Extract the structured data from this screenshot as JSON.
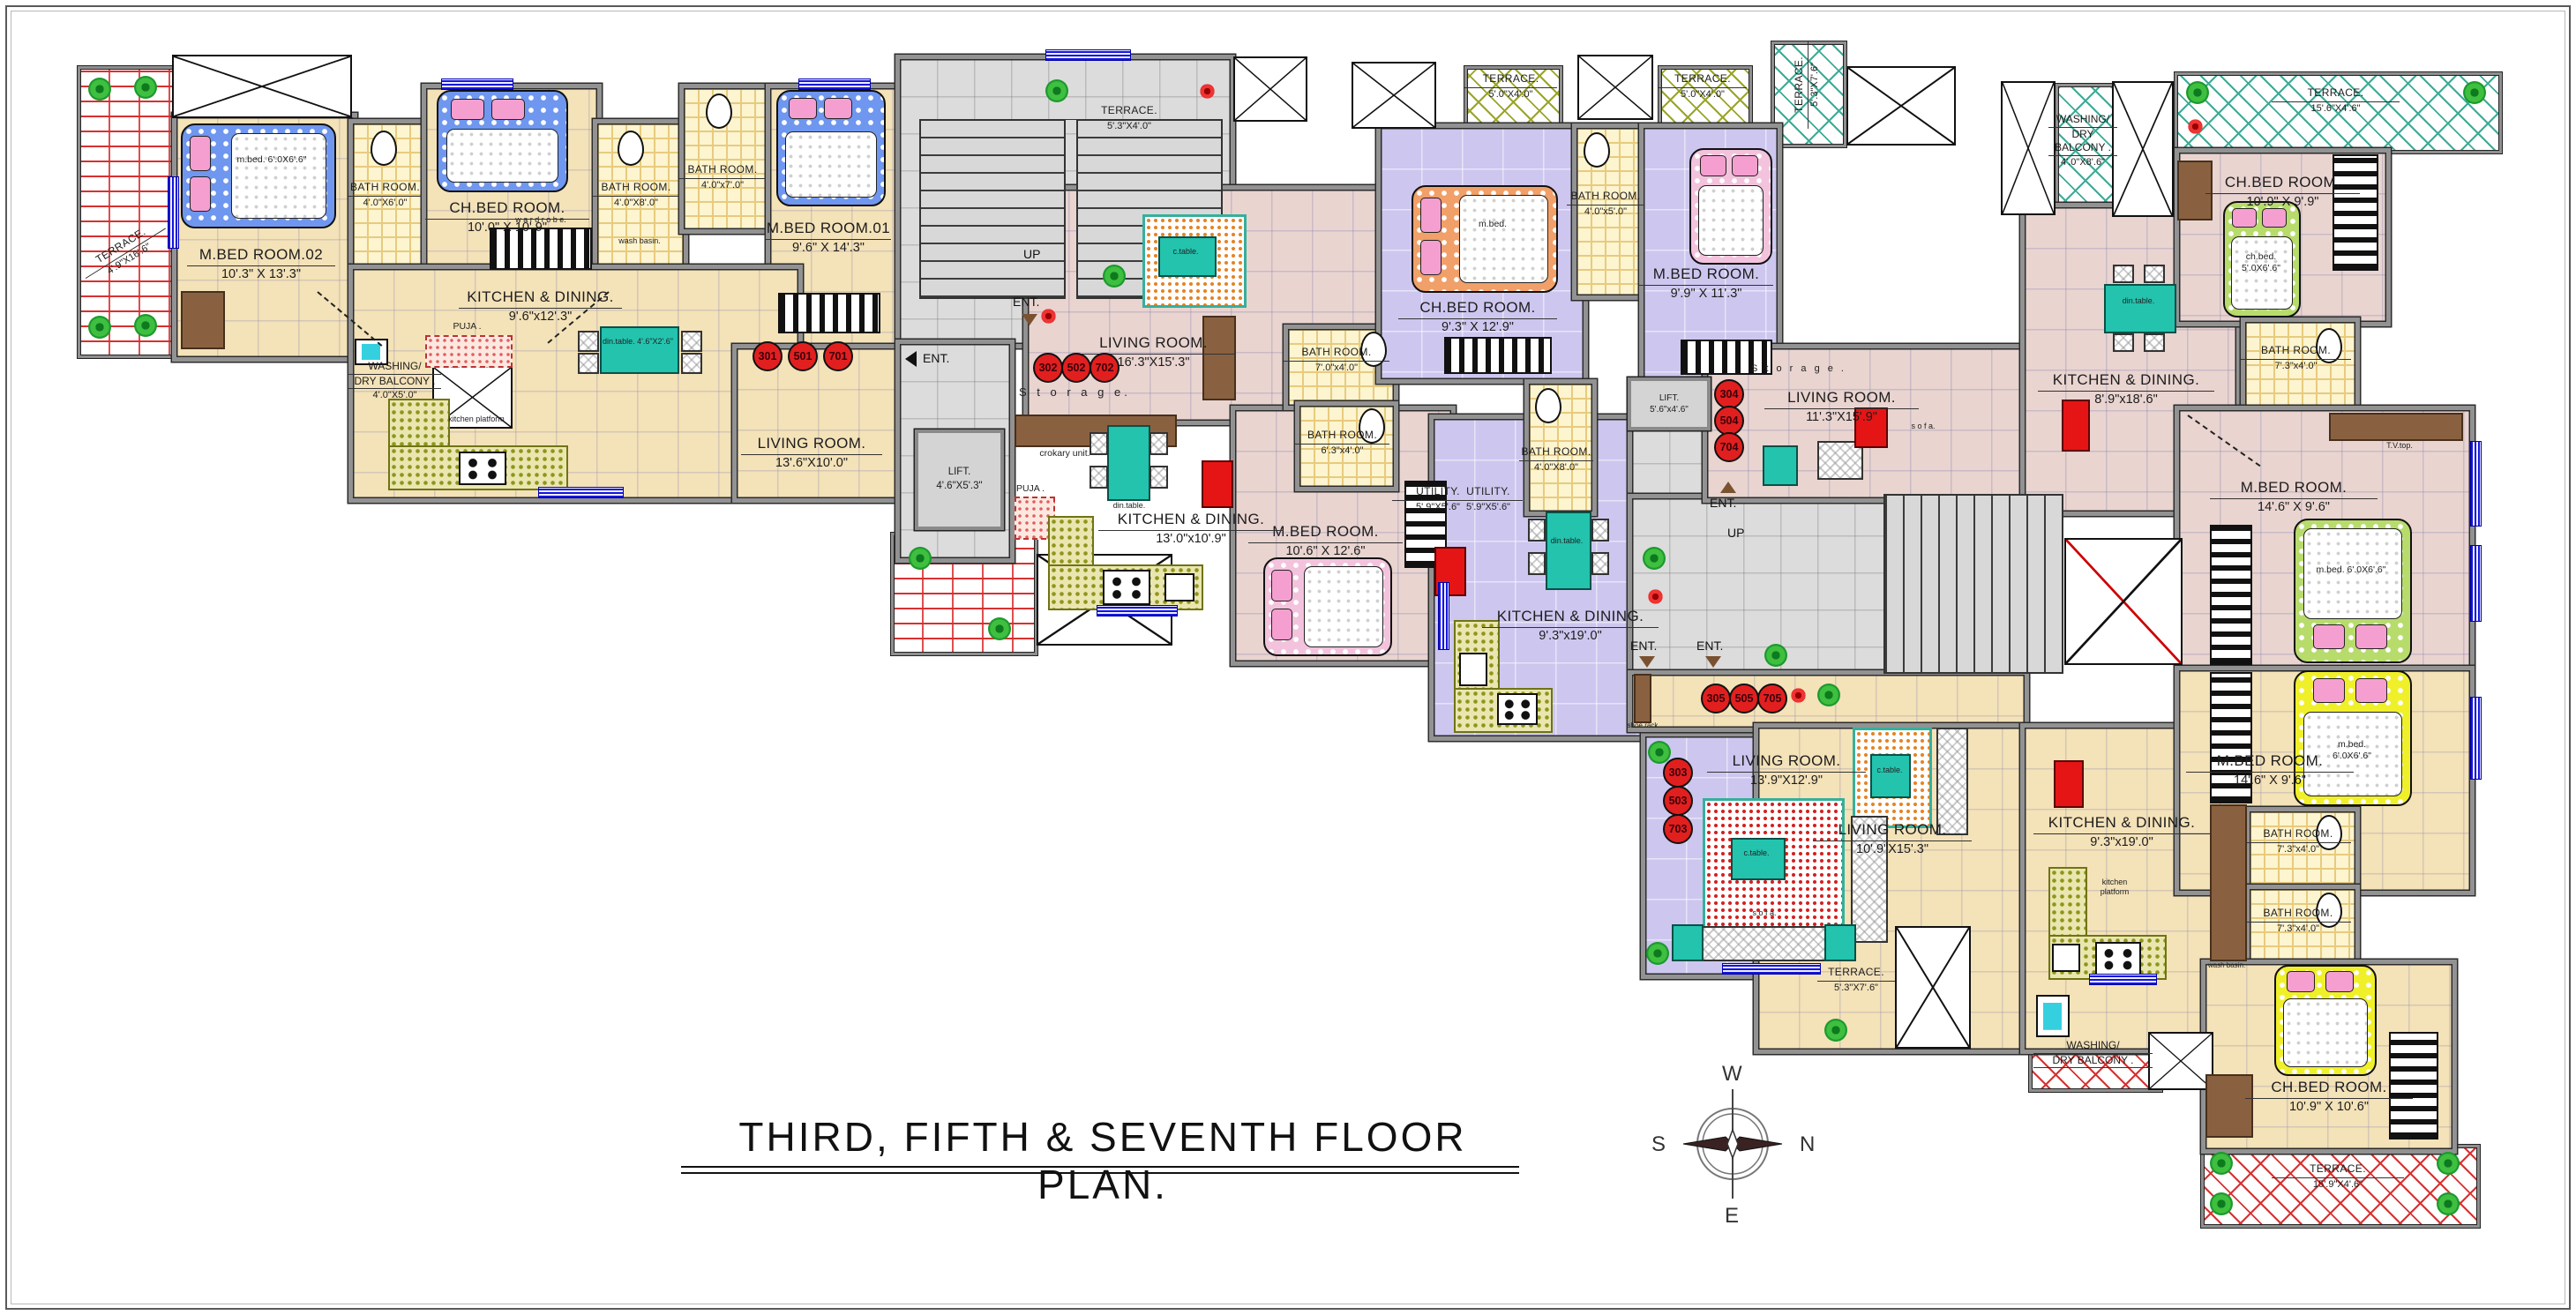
{
  "title": {
    "text": "THIRD, FIFTH & SEVENTH FLOOR PLAN."
  },
  "compass": {
    "west": "W",
    "south": "S",
    "north": "N",
    "east": "E"
  },
  "colors": {
    "wall": "#929292",
    "window_blue": "#1515dd",
    "unit_number_red": "#e21f1f",
    "furniture_teal": "#23c3ae",
    "terrace_red": "#d83030",
    "terrace_teal": "#3cab96",
    "floor_tan": "#f4e2b8",
    "floor_pink": "#e9d4d0",
    "floor_lavender": "#cdc7ef"
  },
  "cores": {
    "left": {
      "ent": "ENT.",
      "up": "UP",
      "lift_name": "LIFT.",
      "lift_dims": "4'.6\"X5'.3\""
    },
    "right": {
      "ent": "ENT.",
      "up": "UP",
      "lift_name": "LIFT.",
      "lift_dims": "5'.6\"x4'.6\"",
      "storage": "S t o r a g e ."
    }
  },
  "units": {
    "u301": {
      "numbers": [
        "301",
        "501",
        "701"
      ],
      "terrace": {
        "name": "TERRACE.",
        "dims": "4'.9\"X16'.6\""
      },
      "m_bed_02": {
        "name": "M.BED ROOM.02",
        "dims": "10'.3\" X 13'.3\""
      },
      "bath_1": {
        "name": "BATH ROOM.",
        "dims": "4'.0\"X6'.0\""
      },
      "ch_bed": {
        "name": "CH.BED ROOM.",
        "dims": "10'.0\" X 10'.9\""
      },
      "bath_2": {
        "name": "BATH ROOM.",
        "dims": "4'.0\"X8'.0\""
      },
      "bath_3": {
        "name": "BATH ROOM.",
        "dims": "4'.0\"x7'.0\""
      },
      "m_bed_01": {
        "name": "M.BED ROOM.01",
        "dims": "9'.6\" X 14'.3\""
      },
      "kitchen": {
        "name": "KITCHEN & DINING.",
        "dims": "9'.6\"x12'.3\""
      },
      "living": {
        "name": "LIVING ROOM.",
        "dims": "13'.6\"X10'.0\""
      },
      "puja": "PUJA .",
      "wash_balcony": {
        "line1": "WASHING/",
        "line2": "DRY BALCONY .",
        "dims": "4'.0\"X5'.0\""
      }
    },
    "u302": {
      "numbers": [
        "302",
        "502",
        "702"
      ],
      "terrace": {
        "name": "TERRACE.",
        "dims": "5'.3\"X4'.0\""
      },
      "living": {
        "name": "LIVING ROOM.",
        "dims": "16'.3\"X15'.3\""
      },
      "kitchen": {
        "name": "KITCHEN & DINING.",
        "dims": "13'.0\"x10'.9\""
      },
      "m_bed": {
        "name": "M.BED ROOM.",
        "dims": "10'.6\" X 12'.6\""
      },
      "bath_1": {
        "name": "BATH ROOM.",
        "dims": "7'.0\"x4'.0\""
      },
      "bath_2": {
        "name": "BATH ROOM.",
        "dims": "6'.3\"x4'.0\""
      },
      "utility": {
        "name": "UTILITY.",
        "dims": "5'.9\"X5'.6\""
      },
      "puja": "PUJA .",
      "storage": "S t o r a g e.",
      "crokary": "crokary unit."
    },
    "u303": {
      "numbers": [
        "303",
        "503",
        "703"
      ],
      "terrace_1": {
        "name": "TERRACE.",
        "dims": "5'.0\"X4'.0\""
      },
      "terrace_2": {
        "name": "TERRACE.",
        "dims": "5'.0\"X4'.0\""
      },
      "ch_bed": {
        "name": "CH.BED ROOM.",
        "dims": "9'.3\" X 12'.9\""
      },
      "m_bed": {
        "name": "M.BED ROOM.",
        "dims": "9'.9\" X 11'.3\""
      },
      "bath_1": {
        "name": "BATH ROOM.",
        "dims": "4'.0\"x5'.0\""
      },
      "bath_2": {
        "name": "BATH ROOM.",
        "dims": "4'.0\"X8'.0\""
      },
      "utility": {
        "name": "UTILITY.",
        "dims": "5'.9\"X5'.6\""
      },
      "kitchen": {
        "name": "KITCHEN & DINING.",
        "dims": "9'.3\"x19'.0\""
      },
      "living": {
        "name": "LIVING ROOM.",
        "dims": "13'.9\"X12'.9\""
      }
    },
    "u304": {
      "numbers": [
        "304",
        "504",
        "704"
      ],
      "living": {
        "name": "LIVING ROOM.",
        "dims": "11'.3\"X15'.9\""
      },
      "kitchen": {
        "name": "KITCHEN & DINING.",
        "dims": "8'.9\"x18'.6\""
      },
      "wash_balcony": {
        "line1": "WASHING/",
        "line2": "DRY BALCONY .",
        "dims": "4'.0\"X8'.6\""
      },
      "terrace_top": {
        "name": "TERRACE.",
        "dims": "15'.6\"X4'.6\""
      },
      "terrace_side": {
        "name": "TERRACE.",
        "dims": "5'.3\"X7'.6\""
      },
      "ch_bed": {
        "name": "CH.BED ROOM.",
        "dims": "10'.9\" X 9'.9\""
      },
      "bath": {
        "name": "BATH ROOM.",
        "dims": "7'.3\"x4'.0\""
      },
      "m_bed": {
        "name": "M.BED ROOM.",
        "dims": "14'.6\" X 9'.6\""
      }
    },
    "u305": {
      "numbers": [
        "305",
        "505",
        "705"
      ],
      "living": {
        "name": "LIVING ROOM.",
        "dims": "10'.9\"X15'.3\""
      },
      "kitchen": {
        "name": "KITCHEN & DINING.",
        "dims": "9'.3\"x19'.0\""
      },
      "m_bed": {
        "name": "M.BED ROOM.",
        "dims": "14'.6\" X 9'.6\""
      },
      "bath_1": {
        "name": "BATH ROOM.",
        "dims": "7'.3\"x4'.0\""
      },
      "bath_2": {
        "name": "BATH ROOM.",
        "dims": "7'.3\"x4'.0\""
      },
      "ch_bed": {
        "name": "CH.BED ROOM.",
        "dims": "10'.9\" X 10'.6\""
      },
      "terrace_side": {
        "name": "TERRACE.",
        "dims": "5'.3\"X7'.6\""
      },
      "terrace_bottom": {
        "name": "TERRACE.",
        "dims": "15'.9\"X4'.6\""
      },
      "wash_balcony": {
        "line1": "WASHING/",
        "line2": "DRY BALCONY .",
        "dims": ""
      }
    }
  },
  "furniture": {
    "din_table": "din.table.",
    "din_table_dims": "4'.6\"X2'.6\"",
    "c_table": "c.table.",
    "sofa": "s o f a.",
    "wardrobe": "w a r d r o b e.",
    "kitchen_platform": "kitchen platform",
    "wash_basin": "wash basin.",
    "tv_top": "T.V.top.",
    "m_bed": "m.bed.",
    "m_bed_dims": "6'.0X6'.6\"",
    "ch_bed": "ch.bed.",
    "ch_bed_dims": "5'.0X6'.6\"",
    "shoe_rack": "shoe rack",
    "washing_machine": "washing machine",
    "storage": "S t o r a g e ."
  }
}
